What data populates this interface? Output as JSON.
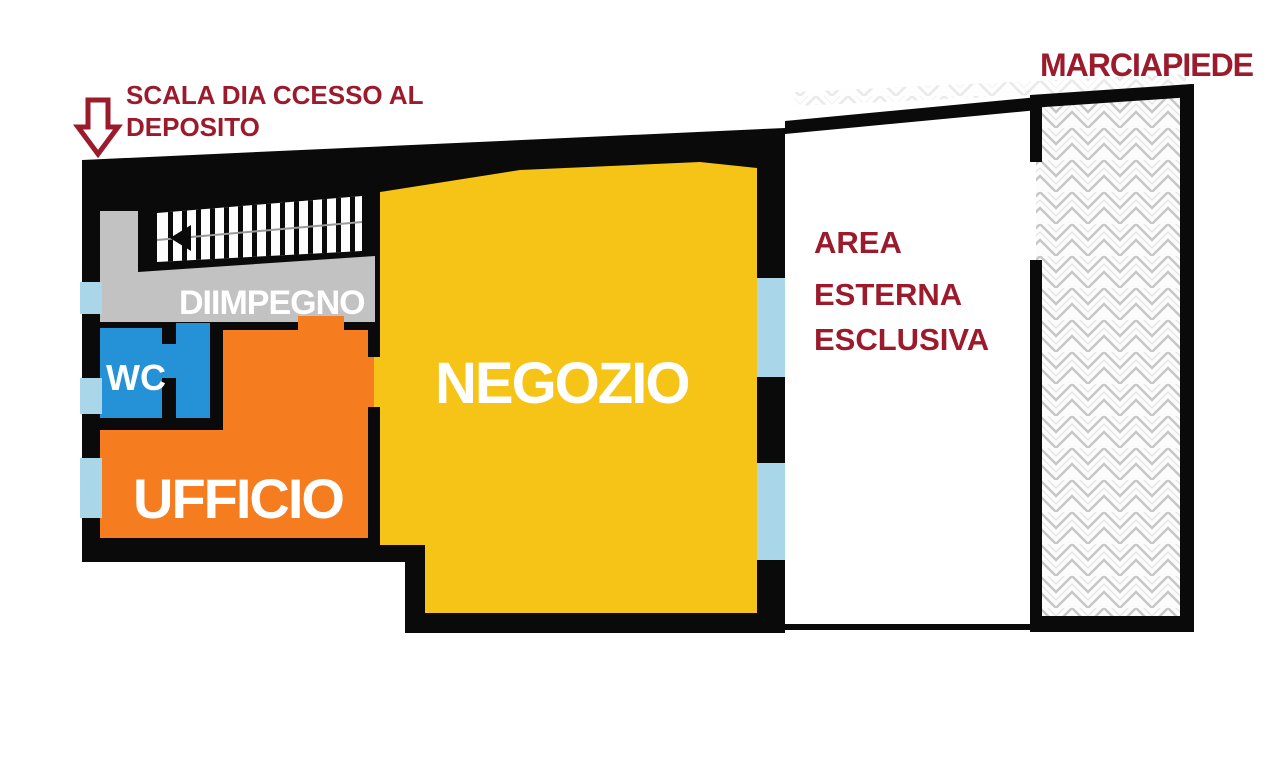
{
  "annotations": {
    "scala": {
      "line1": "SCALA DIA CCESSO AL",
      "line2": "DEPOSITO"
    },
    "marciapiede": "MARCIAPIEDE",
    "area_esterna": {
      "line1": "AREA",
      "line2": "ESTERNA",
      "line3": "ESCLUSIVA"
    }
  },
  "rooms": {
    "negozio": "NEGOZIO",
    "ufficio": "UFFICIO",
    "wc": "WC",
    "diimpegno": "DIIMPEGNO"
  },
  "colors": {
    "negozio": "#F6C417",
    "ufficio": "#F57D1F",
    "wc": "#2592D8",
    "corridor": "#C2C2C2",
    "window": "#A9D6E8",
    "wall": "#0A0A0A",
    "annotation": "#9B1B2D",
    "room_label": "#FFFFFF",
    "stair_tread": "#FDFDFD"
  }
}
